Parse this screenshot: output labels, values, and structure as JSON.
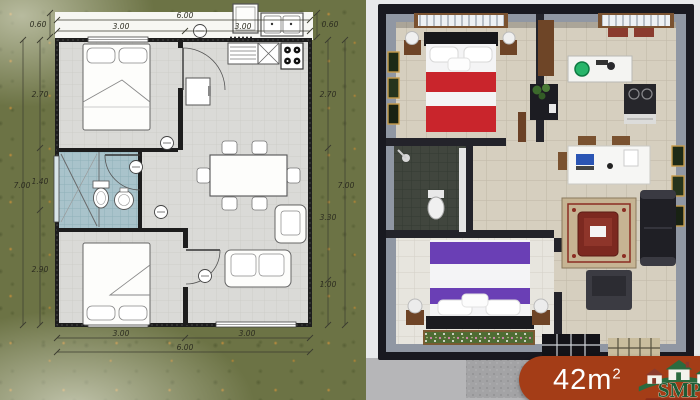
{
  "plan": {
    "top": {
      "corner_left": "0.60",
      "seg_left": "3.00",
      "total": "6.00",
      "seg_right": "3.00",
      "corner_right": "0.60"
    },
    "left": {
      "seg_top": "2.70",
      "seg_mid": "1.40",
      "seg_bottom": "2.90",
      "total": "7.00"
    },
    "right": {
      "seg_top": "2.70",
      "seg_mid": "3.30",
      "seg_bottom": "1.00",
      "total": "7.00"
    },
    "bottom": {
      "seg_left": "3.00",
      "seg_right": "3.00",
      "total": "6.00"
    }
  },
  "badge": {
    "area_value": "42m",
    "area_exponent": "2",
    "logo_text": "SMP"
  },
  "colors": {
    "badge_bg": "#a43d17",
    "logo_green": "#2a6b3f",
    "grass": "#6c7345",
    "bath_tile": "#a9c3cb",
    "bed_red": "#c9252c",
    "bed_purple": "#6a3fb5"
  }
}
